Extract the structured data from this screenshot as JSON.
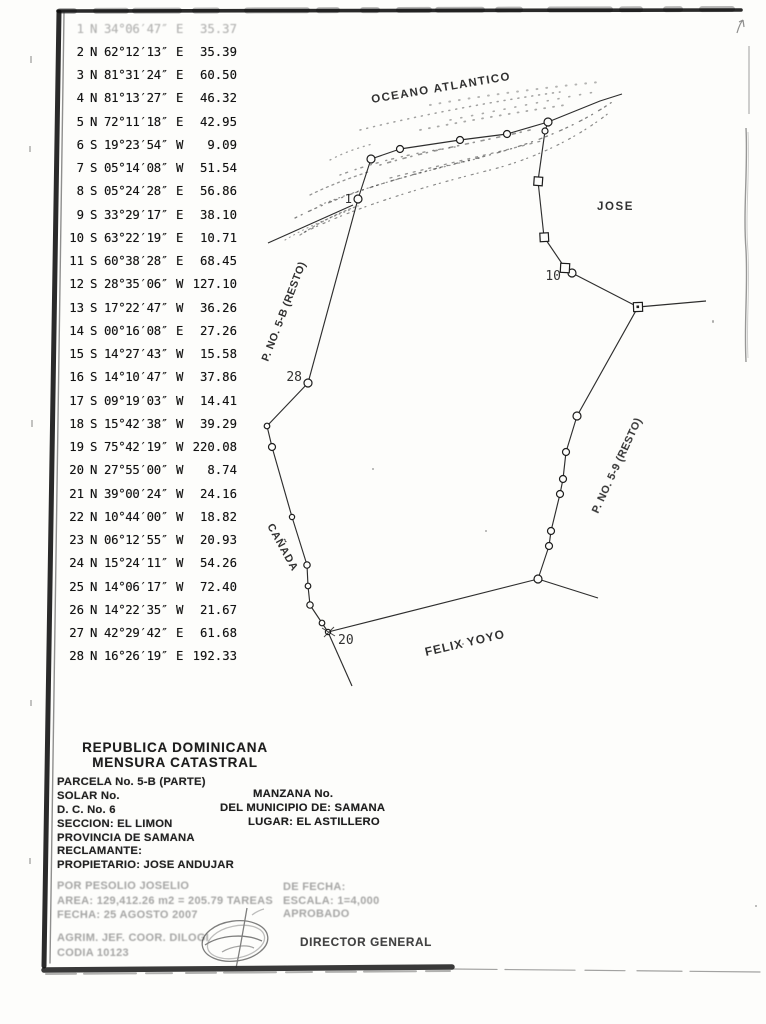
{
  "bearing_table": {
    "rows": [
      {
        "no": "1",
        "ns": "N",
        "angle": "34°06′47″",
        "ew": "E",
        "dist": "35.37",
        "faded": true
      },
      {
        "no": "2",
        "ns": "N",
        "angle": "62°12′13″",
        "ew": "E",
        "dist": "35.39"
      },
      {
        "no": "3",
        "ns": "N",
        "angle": "81°31′24″",
        "ew": "E",
        "dist": "60.50"
      },
      {
        "no": "4",
        "ns": "N",
        "angle": "81°13′27″",
        "ew": "E",
        "dist": "46.32"
      },
      {
        "no": "5",
        "ns": "N",
        "angle": "72°11′18″",
        "ew": "E",
        "dist": "42.95"
      },
      {
        "no": "6",
        "ns": "S",
        "angle": "19°23′54″",
        "ew": "W",
        "dist": "9.09"
      },
      {
        "no": "7",
        "ns": "S",
        "angle": "05°14′08″",
        "ew": "W",
        "dist": "51.54"
      },
      {
        "no": "8",
        "ns": "S",
        "angle": "05°24′28″",
        "ew": "E",
        "dist": "56.86"
      },
      {
        "no": "9",
        "ns": "S",
        "angle": "33°29′17″",
        "ew": "E",
        "dist": "38.10"
      },
      {
        "no": "10",
        "ns": "S",
        "angle": "63°22′19″",
        "ew": "E",
        "dist": "10.71"
      },
      {
        "no": "11",
        "ns": "S",
        "angle": "60°38′28″",
        "ew": "E",
        "dist": "68.45"
      },
      {
        "no": "12",
        "ns": "S",
        "angle": "28°35′06″",
        "ew": "W",
        "dist": "127.10"
      },
      {
        "no": "13",
        "ns": "S",
        "angle": "17°22′47″",
        "ew": "W",
        "dist": "36.26"
      },
      {
        "no": "14",
        "ns": "S",
        "angle": "00°16′08″",
        "ew": "E",
        "dist": "27.26"
      },
      {
        "no": "15",
        "ns": "S",
        "angle": "14°27′43″",
        "ew": "W",
        "dist": "15.58"
      },
      {
        "no": "16",
        "ns": "S",
        "angle": "14°10′47″",
        "ew": "W",
        "dist": "37.86"
      },
      {
        "no": "17",
        "ns": "S",
        "angle": "09°19′03″",
        "ew": "W",
        "dist": "14.41"
      },
      {
        "no": "18",
        "ns": "S",
        "angle": "15°42′38″",
        "ew": "W",
        "dist": "39.29"
      },
      {
        "no": "19",
        "ns": "S",
        "angle": "75°42′19″",
        "ew": "W",
        "dist": "220.08"
      },
      {
        "no": "20",
        "ns": "N",
        "angle": "27°55′00″",
        "ew": "W",
        "dist": "8.74"
      },
      {
        "no": "21",
        "ns": "N",
        "angle": "39°00′24″",
        "ew": "W",
        "dist": "24.16"
      },
      {
        "no": "22",
        "ns": "N",
        "angle": "10°44′00″",
        "ew": "W",
        "dist": "18.82"
      },
      {
        "no": "23",
        "ns": "N",
        "angle": "06°12′55″",
        "ew": "W",
        "dist": "20.93"
      },
      {
        "no": "24",
        "ns": "N",
        "angle": "15°24′11″",
        "ew": "W",
        "dist": "54.26"
      },
      {
        "no": "25",
        "ns": "N",
        "angle": "14°06′17″",
        "ew": "W",
        "dist": "72.40"
      },
      {
        "no": "26",
        "ns": "N",
        "angle": "14°22′35″",
        "ew": "W",
        "dist": "21.67"
      },
      {
        "no": "27",
        "ns": "N",
        "angle": "42°29′42″",
        "ew": "E",
        "dist": "61.68"
      },
      {
        "no": "28",
        "ns": "N",
        "angle": "16°26′19″",
        "ew": "E",
        "dist": "192.33"
      }
    ]
  },
  "map": {
    "labels": {
      "ocean": "OCEANO ATLANTICO",
      "jose": "JOSE",
      "parcel_5b": "P. NO. 5-B (RESTO)",
      "parcel_59": "P. NO. 5-9 (RESTO)",
      "canada": "CAÑADA",
      "felix_yoyo": "FELIX YOYO",
      "vertex_1": "1",
      "vertex_10": "10",
      "vertex_20": "20",
      "vertex_28": "28"
    }
  },
  "form": {
    "title_line1": "REPUBLICA DOMINICANA",
    "title_line2": "MENSURA CATASTRAL",
    "left_fields": [
      "PARCELA No. 5-B (PARTE)",
      "SOLAR No.",
      "D. C. No. 6",
      "SECCION: EL LIMON",
      "PROVINCIA DE SAMANA",
      "RECLAMANTE:",
      "PROPIETARIO: JOSE ANDUJAR"
    ],
    "right_fields": [
      "MANZANA No.",
      "DEL MUNICIPIO DE: SAMANA",
      "LUGAR: EL ASTILLERO"
    ],
    "faded_left": [
      "POR PESOLIO JOSELIO",
      "AREA: 129,412.26 m2 = 205.79 TAREAS",
      "FECHA: 25 AGOSTO 2007"
    ],
    "faded_right": [
      "DE FECHA:",
      "ESCALA: 1=4,000",
      "APROBADO"
    ],
    "signature_line": "AGRIM. JEF. COOR. DILOGI",
    "codia_line": "CODIA 10123",
    "director_label": "DIRECTOR GENERAL"
  }
}
